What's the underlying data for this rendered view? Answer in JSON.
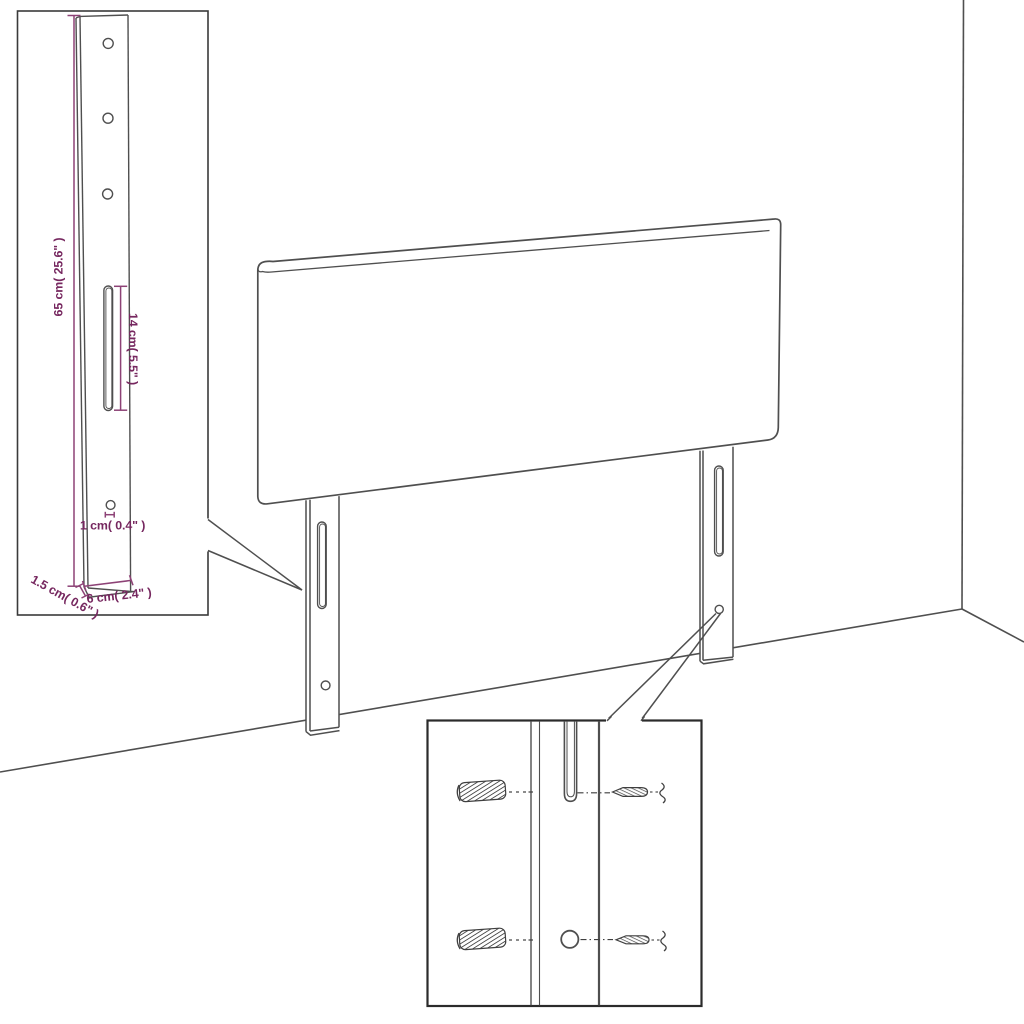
{
  "diagram": {
    "description": "Headboard with two mounting legs shown in a room corner, with two detail callouts",
    "colors": {
      "background": "#ffffff",
      "outline": "#4f4f4f",
      "callout_border": "#2e2e2e",
      "dimension_line": "#8d4276",
      "dimension_text": "#76275f"
    }
  },
  "callouts": {
    "leg_detail": {
      "height_label": "65 cm( 25.6\" )",
      "slot_label": "14 cm( 5.5\" )",
      "hole_label": "1 cm( 0.4\" )",
      "thickness_label": "1.5 cm( 0.6\" )",
      "width_label": "6 cm( 2.4\" )"
    },
    "mounting_detail": {
      "parts": [
        "wall-anchor",
        "screw",
        "keyhole-slot",
        "screw-hole"
      ]
    }
  }
}
